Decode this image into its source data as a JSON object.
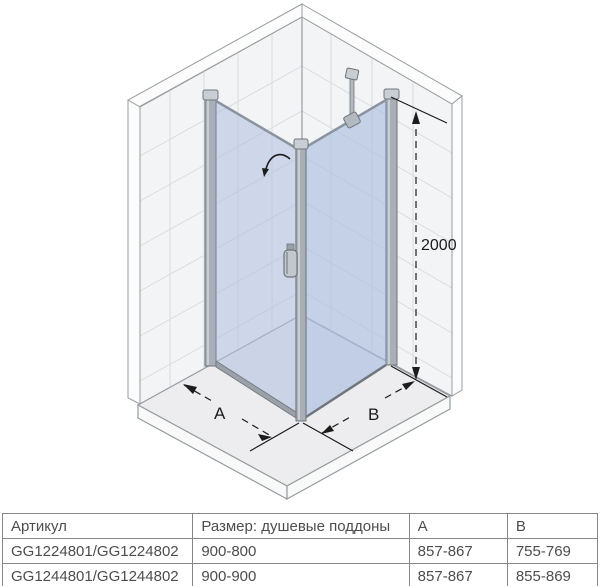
{
  "diagram": {
    "dimension_labels": {
      "height": "2000",
      "door_width": "A",
      "panel_width": "B"
    },
    "icons": [
      "door-swing-arrow",
      "door-handle",
      "support-bar"
    ],
    "colors": {
      "tile": "#f3f4f5",
      "grout": "#d9dcdf",
      "band": "#fcfcfd",
      "tray": "#ededef",
      "trayface": "#f9f9fa",
      "outline": "#979ca1",
      "profile": "#a9afb6",
      "profilecap": "#c9ced4",
      "profiledge": "#70767d",
      "glass": "#aebfe0",
      "glassedge": "#7d8ca6",
      "frame": "#8b93a0",
      "bottombar": "#9ba1a9",
      "dimension": "#1c1c1c"
    }
  },
  "table": {
    "headers": [
      "Артикул",
      "Размер: душевые поддоны",
      "A",
      "B"
    ],
    "rows": [
      [
        "GG1224801/GG1224802",
        "900-800",
        "857-867",
        "755-769"
      ],
      [
        "GG1244801/GG1244802",
        "900-900",
        "857-867",
        "855-869"
      ]
    ]
  }
}
